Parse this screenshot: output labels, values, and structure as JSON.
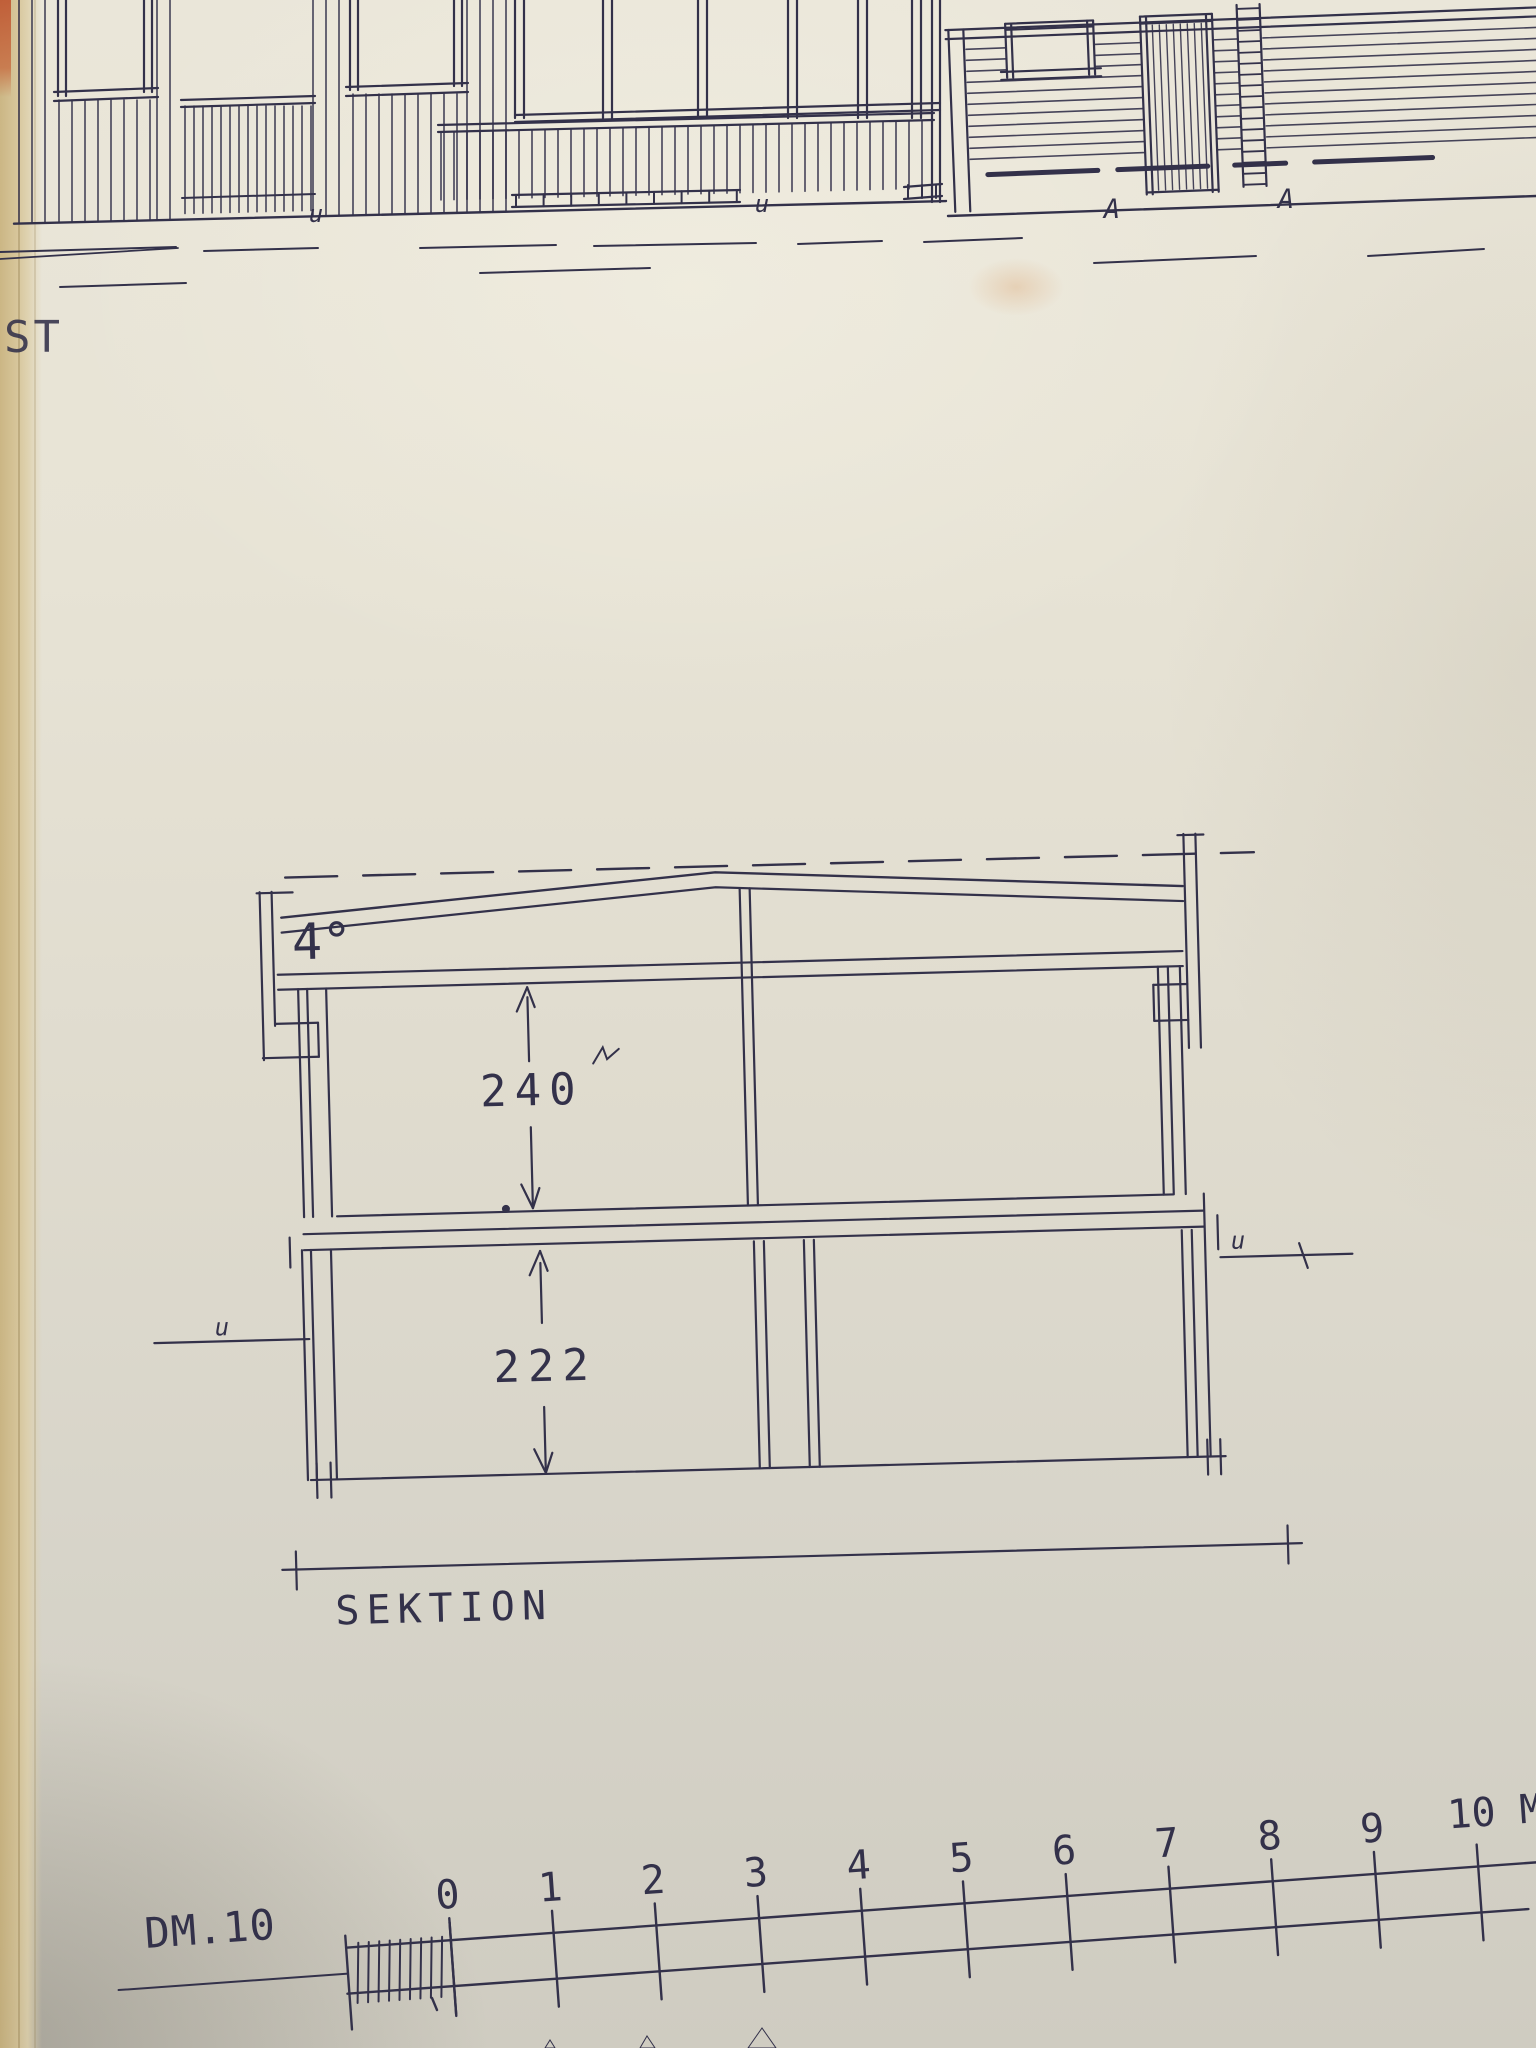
{
  "labels": {
    "left_edge_text": "ST"
  },
  "marks": {
    "u": "u",
    "a": "A"
  },
  "section": {
    "roof_angle": "4°",
    "upper_height": "240",
    "lower_height": "222",
    "title": "SEKTION"
  },
  "scale_bar": {
    "label": "DM.10",
    "ticks": [
      "0",
      "1",
      "2",
      "3",
      "4",
      "5",
      "6",
      "7",
      "8",
      "9"
    ],
    "end_label": "10 M",
    "units_per_tick": 1,
    "subdivisions_left_of_zero": 10
  },
  "colors": {
    "ink": "#33314a",
    "paper": "#e4e0d2",
    "paper_edge": "#cdb687",
    "red_tab": "#bf5530",
    "pencil": "#908a7a"
  }
}
